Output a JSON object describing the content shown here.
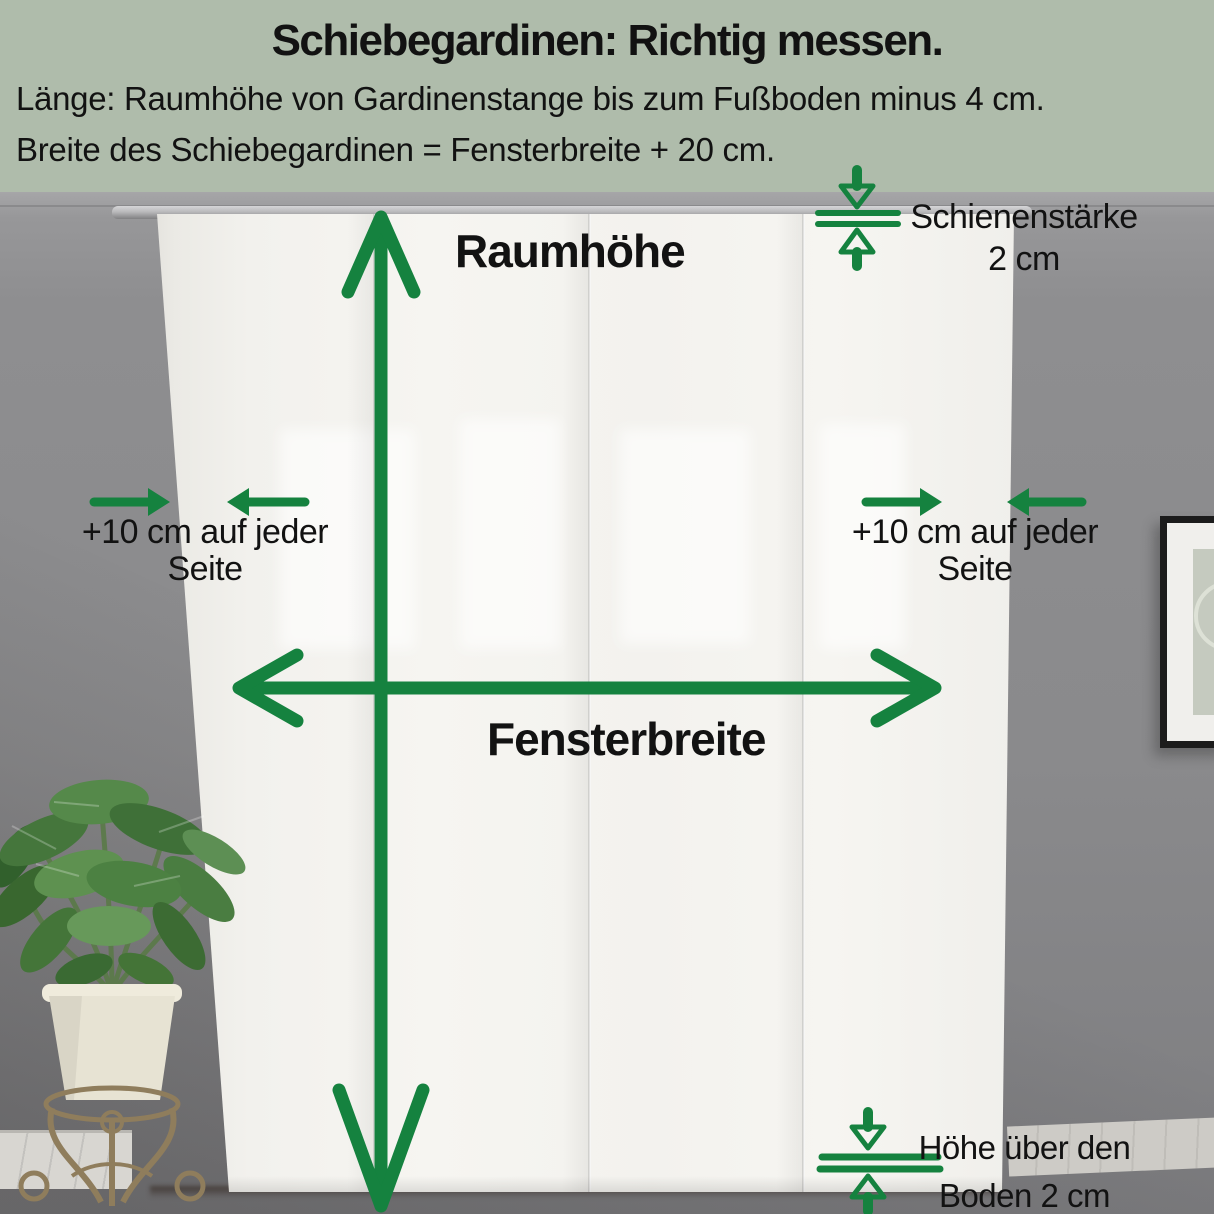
{
  "colors": {
    "header_bg": "#afbcab",
    "accent_green": "#15823f",
    "text": "#121212",
    "wall_gray": "#8a8a8c",
    "curtain_white": "#f3f2ee",
    "floor_brown": "#56392b"
  },
  "header": {
    "title": "Schiebegardinen: Richtig messen.",
    "line1": "Länge: Raumhöhe von Gardinenstange bis zum Fußboden minus 4 cm.",
    "line2": "Breite des Schiebegardinen = Fensterbreite + 20 cm."
  },
  "labels": {
    "room_height": "Raumhöhe",
    "window_width": "Fensterbreite",
    "rail_line1": "Schienenstärke",
    "rail_line2": "2 cm",
    "side_left_line1": "+10 cm auf jeder",
    "side_left_line2": "Seite",
    "side_right_line1": "+10 cm auf jeder",
    "side_right_line2": "Seite",
    "floor_line1": "Höhe über den",
    "floor_line2": "Boden 2 cm"
  }
}
